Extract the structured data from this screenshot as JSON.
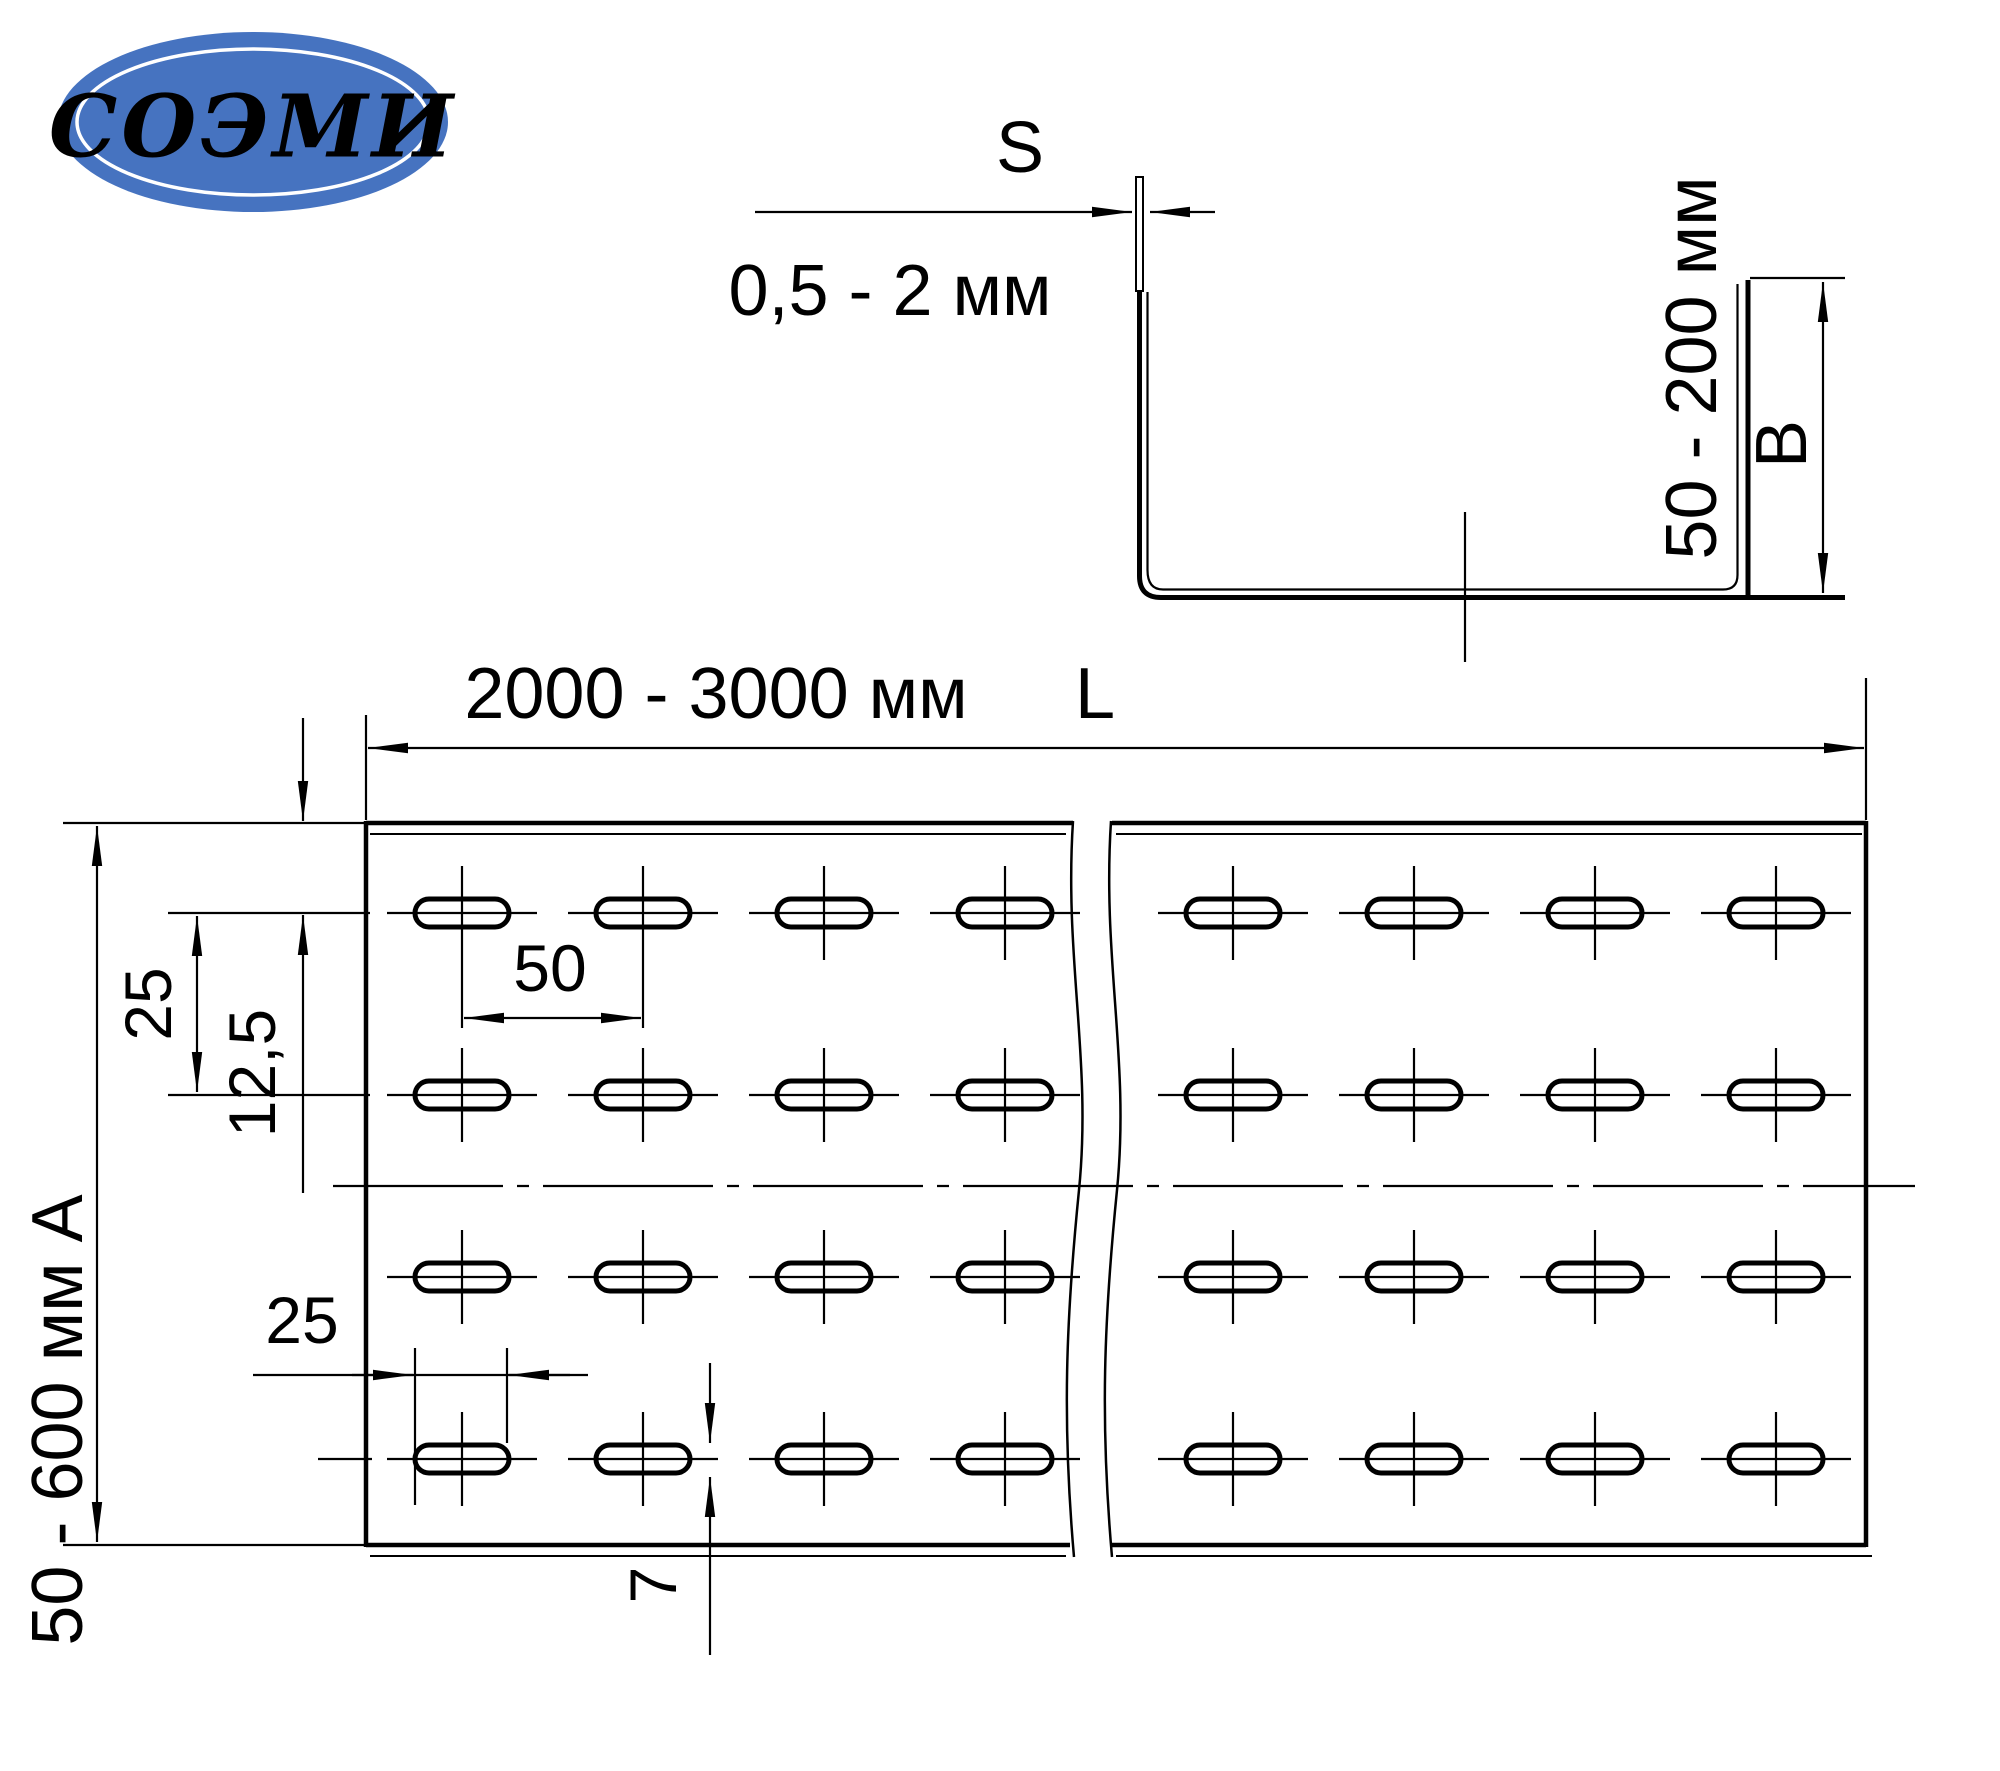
{
  "page": {
    "background": "#ffffff",
    "line_color": "#000000"
  },
  "logo": {
    "text": "СОЭМИ",
    "bg_color": "#4673c0",
    "text_color": "#ffffff"
  },
  "section_view": {
    "thickness_letter": "S",
    "thickness_range": "0,5 - 2 мм",
    "height_range": "50 - 200 мм",
    "height_letter": "B"
  },
  "plan_view": {
    "length_range": "2000 - 3000 мм",
    "length_letter": "L",
    "width_range_letter": "50 - 600 мм    А",
    "row_pitch": "25",
    "row_offset": "12,5",
    "col_pitch": "50",
    "slot_length": "25",
    "slot_width": "7"
  },
  "grid": {
    "rows_y": [
      913,
      1095,
      1277,
      1459
    ],
    "cols_left": [
      462,
      643,
      824,
      1005
    ],
    "cols_right": [
      1233,
      1414,
      1595,
      1776
    ],
    "slot_w": 94,
    "slot_h": 28,
    "slot_r": 14,
    "slot_stroke": 5,
    "h_ext": 75,
    "v_ext": 47,
    "axis_stroke": 2.2,
    "special_vaxis": {
      "row": 913,
      "cols": [
        462,
        643
      ],
      "y1": 866,
      "y2": 1028
    }
  }
}
